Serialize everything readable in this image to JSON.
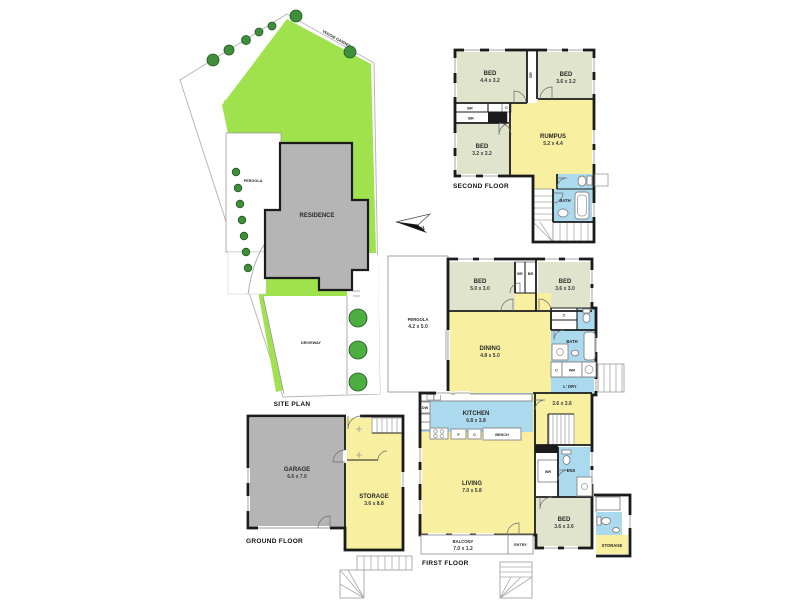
{
  "colors": {
    "wall": "#1b1b1b",
    "room_yellow": "#F8EFA0",
    "room_green": "#E0E4CC",
    "room_blue": "#ABDAEF",
    "building_gray": "#B5B5B5",
    "lawn_green": "#9FE24E",
    "tree_green": "#3E8E3B",
    "tree_bright": "#4CAE3F"
  },
  "north": {
    "label": "N"
  },
  "site_plan": {
    "title": "SITE PLAN",
    "veggie_garden": "VEGGIE GARDEN",
    "pergola": "PERGOLA",
    "residence": "RESIDENCE",
    "driveway": "DRIVEWAY"
  },
  "second_floor": {
    "title": "SECOND FLOOR",
    "bed1": {
      "name": "BED",
      "dims": "4.4 x 3.2"
    },
    "bed2": {
      "name": "BED",
      "dims": "3.6 x 3.2"
    },
    "bed3": {
      "name": "BED",
      "dims": "3.2 x 3.2"
    },
    "rumpus": {
      "name": "RUMPUS",
      "dims": "5.2 x 4.4"
    },
    "bath": "BATH",
    "br_hall": "BR",
    "br_robe1": "BR",
    "br_robe2": "BR",
    "closet": "C"
  },
  "first_floor": {
    "title": "FIRST FLOOR",
    "pergola": {
      "name": "PERGOLA",
      "dims": "4.2 x 5.0"
    },
    "bed1": {
      "name": "BED",
      "dims": "5.0 x 3.0"
    },
    "bed2": {
      "name": "BED",
      "dims": "3.6 x 3.0"
    },
    "bed3": {
      "name": "BED",
      "dims": "3.6 x 3.6"
    },
    "dining": {
      "name": "DINING",
      "dims": "4.8 x 5.0"
    },
    "kitchen": {
      "name": "KITCHEN",
      "dims": "6.8 x 3.8"
    },
    "living": {
      "name": "LIVING",
      "dims": "7.0 x 5.8"
    },
    "stair_room_dims": "3.6 x 3.6",
    "balcony": {
      "name": "BALCONY",
      "dims": "7.0 x 1.2"
    },
    "entry": "ENTRY",
    "storage": "STORAGE",
    "bath": "BATH",
    "ens": "ENS",
    "wr_hall": "WR",
    "wr": "WR",
    "ldry": "L' DRY",
    "bench": "BENCH",
    "dw": "DW",
    "fridge": "F",
    "closet_kitchen": "C",
    "closet_hall": "C",
    "closet_laundry": "C",
    "robe1": "BR",
    "robe2": "BR"
  },
  "ground_floor": {
    "title": "GROUND FLOOR",
    "garage": {
      "name": "GARAGE",
      "dims": "6.6 x 7.0"
    },
    "storage": {
      "name": "STORAGE",
      "dims": "3.6 x 8.8"
    }
  }
}
